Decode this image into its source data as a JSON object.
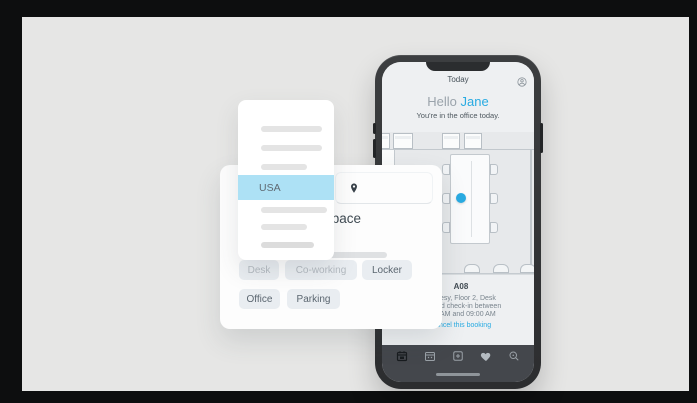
{
  "colors": {
    "accent": "#29abe2",
    "highlight": "#ade1f5",
    "stage-bg": "#0d0e0f",
    "canvas-bg": "#e6e6e5",
    "tabbar-bg": "#44474c"
  },
  "phone": {
    "status_title": "Today",
    "profile_icon": "profile-icon",
    "greeting": "Hello",
    "user_name": "Jane",
    "subtitle": "You're in the office today.",
    "map": {
      "marker_icon": "booked-desk-marker"
    },
    "booking": {
      "space_code": "A08",
      "location_line": "esy, Floor 2, Desk",
      "checkin_line1": "nd check-in between",
      "checkin_line2": "AM and 09:00 AM",
      "cancel_link": "Cancel this booking"
    },
    "tabbar": {
      "icons": [
        {
          "name": "calendar-booking-icon"
        },
        {
          "name": "calendar-schedule-icon"
        },
        {
          "name": "add-booking-icon"
        },
        {
          "name": "favorites-heart-icon"
        },
        {
          "name": "search-icon"
        }
      ]
    }
  },
  "dropdown_card": {
    "selected_option": "USA"
  },
  "search_card": {
    "location_pin_icon": "location-pin-icon",
    "heading_fragment": "space",
    "chips": [
      {
        "label": "Desk",
        "faded": true
      },
      {
        "label": "Co-working",
        "faded": true
      },
      {
        "label": "Locker",
        "faded": false
      },
      {
        "label": "Office",
        "faded": false
      },
      {
        "label": "Parking",
        "faded": false
      }
    ]
  }
}
